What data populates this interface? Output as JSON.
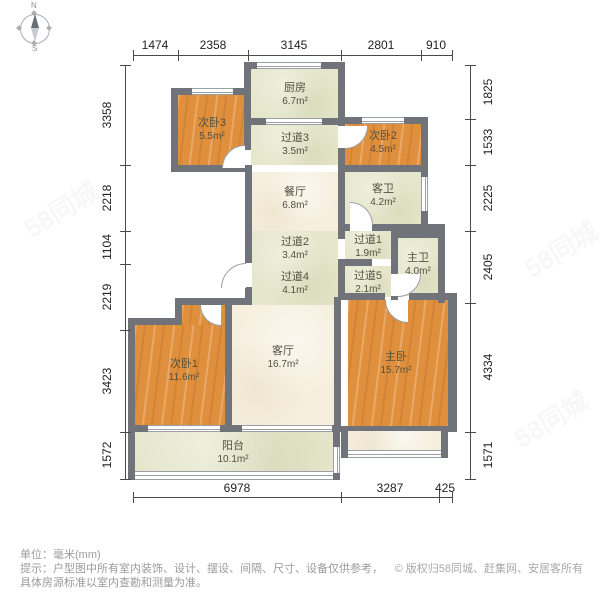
{
  "compass": {
    "north": "N",
    "south": "S"
  },
  "dimensions": {
    "top": [
      "1474",
      "2358",
      "3145",
      "2801",
      "910"
    ],
    "left": [
      "3358",
      "2218",
      "1104",
      "2219",
      "3423",
      "1572"
    ],
    "right": [
      "1825",
      "1533",
      "2225",
      "2405",
      "4334",
      "1571"
    ],
    "bottom": [
      "6978",
      "3287",
      "425"
    ]
  },
  "rooms": [
    {
      "name": "厨房",
      "area": "6.7m²"
    },
    {
      "name": "次卧3",
      "area": "5.5m²"
    },
    {
      "name": "过道3",
      "area": "3.5m²"
    },
    {
      "name": "次卧2",
      "area": "4.5m²"
    },
    {
      "name": "餐厅",
      "area": "6.8m²"
    },
    {
      "name": "客卫",
      "area": "4.2m²"
    },
    {
      "name": "过道2",
      "area": "3.4m²"
    },
    {
      "name": "过道1",
      "area": "1.9m²"
    },
    {
      "name": "过道4",
      "area": "4.1m²"
    },
    {
      "name": "过道5",
      "area": "2.1m²"
    },
    {
      "name": "主卫",
      "area": "4.0m²"
    },
    {
      "name": "次卧1",
      "area": "11.6m²"
    },
    {
      "name": "客厅",
      "area": "16.7m²"
    },
    {
      "name": "主卧",
      "area": "15.7m²"
    },
    {
      "name": "阳台",
      "area": "10.1m²"
    }
  ],
  "footer": {
    "unit_line": "单位：毫米(mm)",
    "tip_line1": "提示：户型图中所有室内装饰、设计、摆设、间隔、尺寸、设备仅供参考，",
    "tip_line2": "具体房源标准以室内查勘和测量为准。",
    "copyright": "© 版权归58同城、赶集网、安居客所有"
  },
  "watermark": {
    "text": "58同城"
  },
  "colors": {
    "wall": "#70747a",
    "bedroom_fill": "#e0903d",
    "hall_fill": "#e5e6cb",
    "living_fill": "#f6efde",
    "dimension_text": "#222222",
    "footer_text": "#9b9b9b"
  }
}
